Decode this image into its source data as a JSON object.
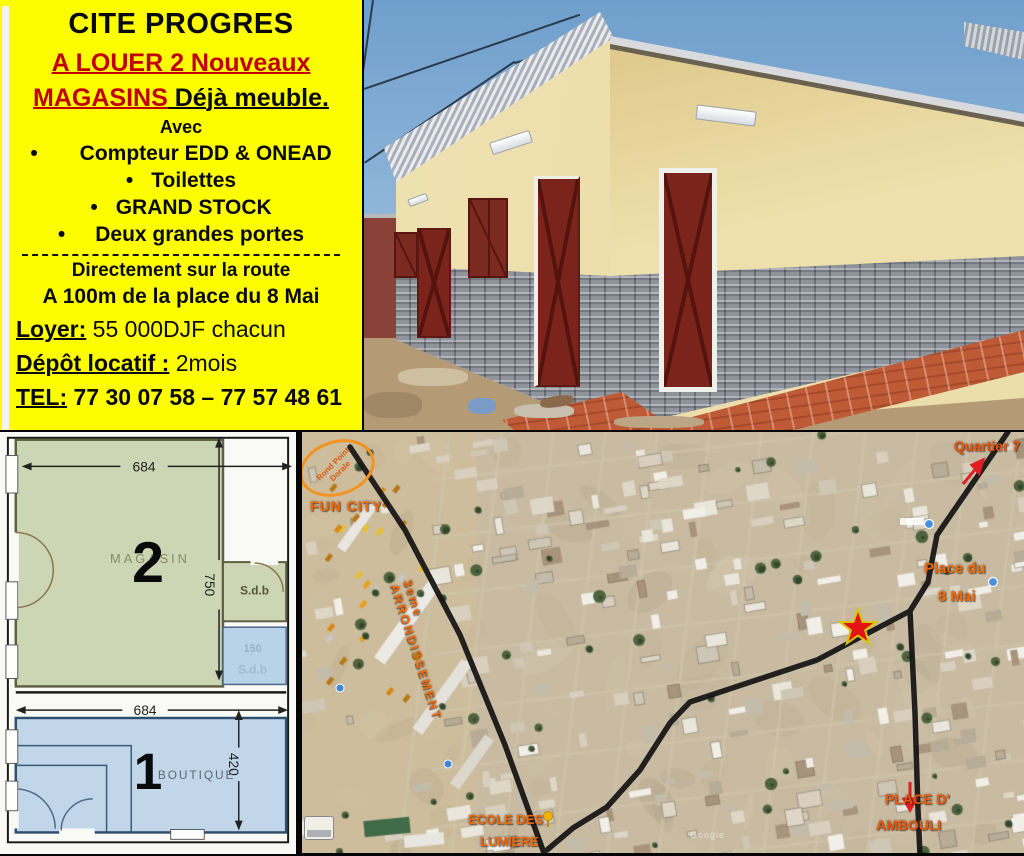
{
  "ad_panel": {
    "title": "CITE PROGRES",
    "subtitle_line1": "A LOUER 2 Nouveaux",
    "subtitle_line2_red": "MAGASINS",
    "subtitle_line2_black": " Déjà meuble. ",
    "avec": "Avec",
    "bullet": "•",
    "features": [
      "Compteur EDD & ONEAD",
      "Toilettes",
      "GRAND STOCK",
      "Deux grandes portes"
    ],
    "location_line1": "Directement sur la route",
    "location_line2": "A 100m de la place du 8 Mai",
    "rent_label": "Loyer:",
    "rent_value": " 55 000DJF chacun",
    "deposit_label": "Dépôt locatif :",
    "deposit_value": " 2mois",
    "tel_label": "TEL:",
    "tel_value": " 77 30 07 58 – 77 57 48 61",
    "colors": {
      "background": "#FDFD00",
      "accent_red": "#C00000",
      "text": "#0A0A0A"
    }
  },
  "floor_plan": {
    "room2": {
      "number": "2",
      "name": "MAGASIN",
      "width_cm": "684",
      "depth_cm": "750"
    },
    "bath_green": {
      "name": "S.d.b"
    },
    "bath_blue": {
      "name": "S.d.b",
      "width_cm": "150"
    },
    "room1": {
      "number": "1",
      "name": "BOUTIQUE",
      "width_cm": "684",
      "depth_cm": "420"
    }
  },
  "map": {
    "labels": {
      "roundabout_line1": "Rond Point",
      "roundabout_line2": "Dorale",
      "fun_city": "FUN CITY",
      "road_line1": "3eme",
      "road_line2": "ARRONDISSEMENT",
      "quartier": "Quartier 7",
      "place_8mai_line1": "Place du",
      "place_8mai_line2": "8 Mai",
      "ecole_line1": "ECOLE DES",
      "ecole_line2": "LUMIERE",
      "ambouli_line1": "PLACE D'",
      "ambouli_line2": "AMBOULI",
      "watermark": "Google"
    },
    "colors": {
      "label_orange": "#ED6B0E",
      "road_black": "#141414",
      "star_red": "#E41414"
    }
  }
}
